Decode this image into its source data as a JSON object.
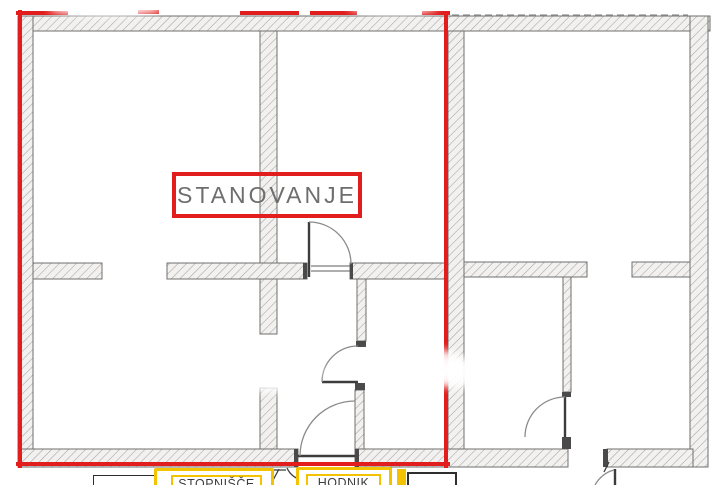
{
  "labels": {
    "apartment": {
      "text": "STANOVANJE"
    },
    "staircase": {
      "text": "STOPNIŠČE"
    },
    "hallway": {
      "text": "HODNIK"
    }
  },
  "colors": {
    "accent_red": "#e11d1d",
    "highlight_yellow": "#f3c300",
    "wall_fill": "#f2f1ef",
    "hatch_line": "#a6a4a2",
    "wall_edge": "#6f6f6f",
    "door_dark": "#3c3c3c",
    "arc_gray": "#8b8b8b",
    "apartment_text": "#6e6e6e",
    "corridor_text": "#3f3f3f",
    "box_border_dark": "#2e2e2e",
    "background": "#fdfdfd"
  }
}
